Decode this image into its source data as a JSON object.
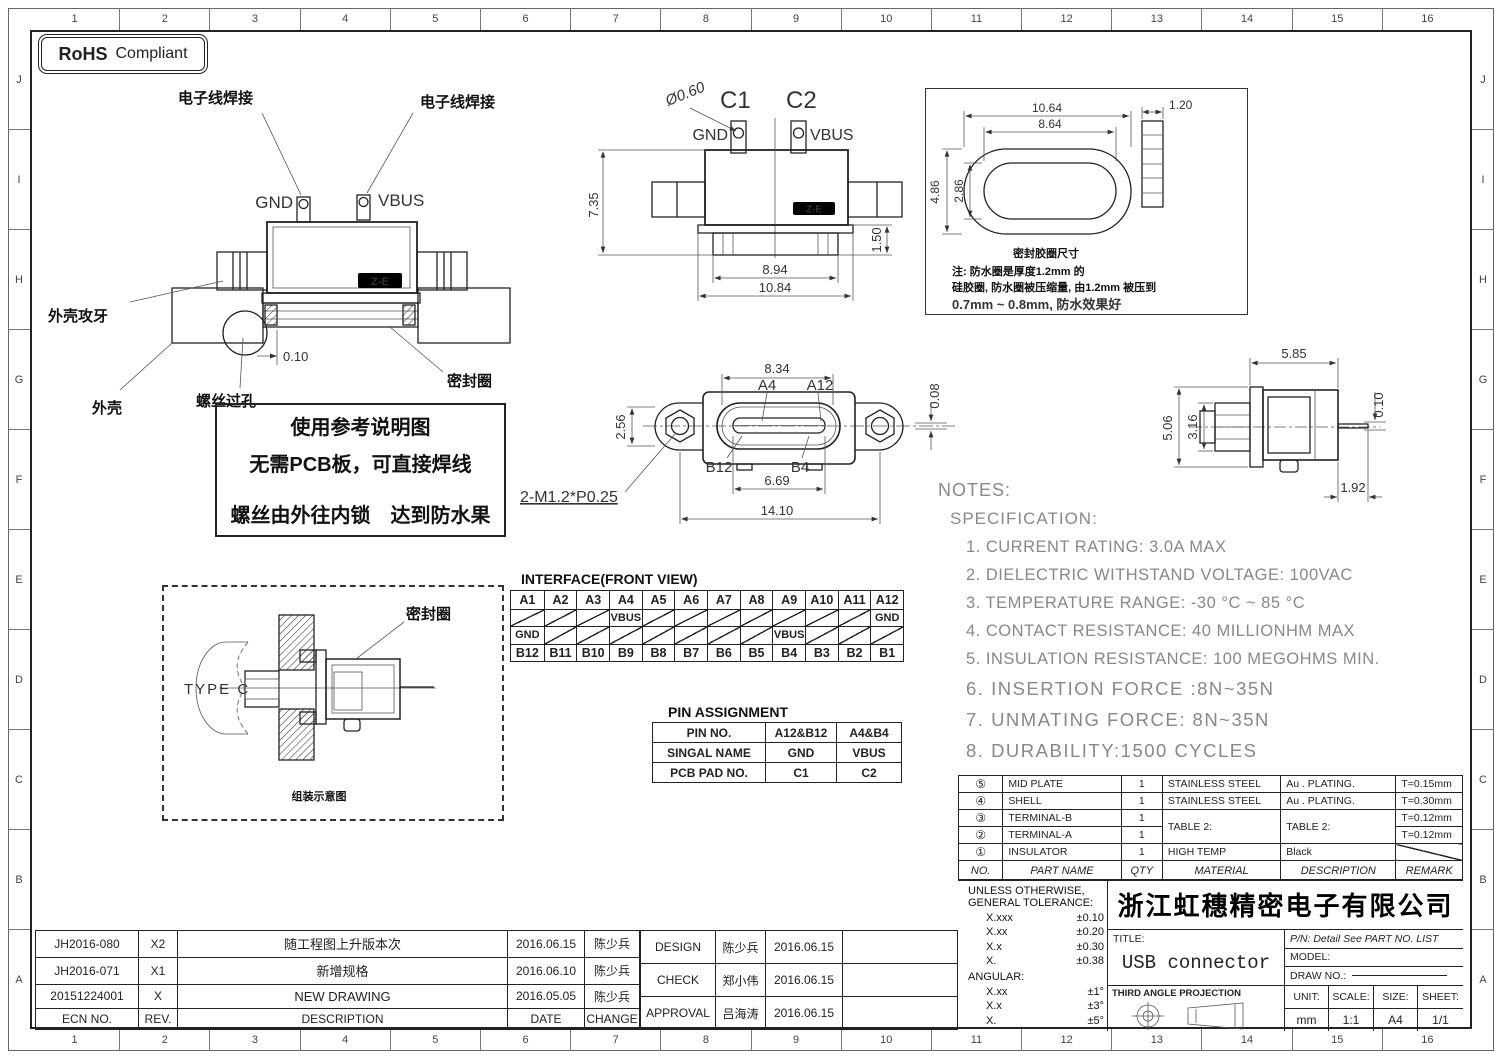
{
  "frame": {
    "cols": [
      "1",
      "2",
      "3",
      "4",
      "5",
      "6",
      "7",
      "8",
      "9",
      "10",
      "11",
      "12",
      "13",
      "14",
      "15",
      "16"
    ],
    "rows": [
      "J",
      "I",
      "H",
      "G",
      "F",
      "E",
      "D",
      "C",
      "B",
      "A"
    ]
  },
  "rohs": {
    "bold": "RoHS",
    "rest": "Compliant"
  },
  "side_view": {
    "wire_weld_left": "电子线焊接",
    "wire_weld_right": "电子线焊接",
    "gnd": "GND",
    "vbus": "VBUS",
    "shell_tap": "外壳攻牙",
    "shell": "外壳",
    "screw_hole": "螺丝过孔",
    "seal_ring": "密封圈",
    "dim_010": "0.10",
    "logo": "Z-E"
  },
  "usage_note": {
    "line1": "使用参考说明图",
    "line2": "无需PCB板，可直接焊线",
    "line3": "螺丝由外往内锁　达到防水果"
  },
  "top_view": {
    "dia": "Ø0.60",
    "c1": "C1",
    "c2": "C2",
    "gnd": "GND",
    "vbus": "VBUS",
    "dim_735": "7.35",
    "dim_894": "8.94",
    "dim_1084": "10.84",
    "dim_150": "1.50",
    "logo": "Z-E"
  },
  "seal_box": {
    "dim_1064": "10.64",
    "dim_864": "8.64",
    "dim_486": "4.86",
    "dim_286": "2.86",
    "dim_120": "1.20",
    "caption": "密封胶圈尺寸",
    "note1": "注: 防水圈是厚度1.2mm 的",
    "note2": "硅胶圈, 防水圈被压缩量, 由1.2mm 被压到",
    "note3": "0.7mm  ~  0.8mm, 防水效果好"
  },
  "front_view": {
    "dim_834": "8.34",
    "a4": "A4",
    "a12": "A12",
    "dim_256": "2.56",
    "dim_008": "0.08",
    "b12": "B12",
    "b4": "B4",
    "dim_669": "6.69",
    "dim_1410": "14.10",
    "thread": "2-M1.2*P0.25"
  },
  "right_view": {
    "dim_585": "5.85",
    "dim_506": "5.06",
    "dim_316": "3.16",
    "dim_010": "0.10",
    "dim_192": "1.92"
  },
  "notes": {
    "title": "NOTES:",
    "subtitle": "SPECIFICATION:",
    "items": [
      "1. CURRENT RATING: 3.0A MAX",
      "2. DIELECTRIC WITHSTAND VOLTAGE: 100VAC",
      "3. TEMPERATURE RANGE: -30 °C ~ 85 °C",
      "4. CONTACT RESISTANCE: 40 MILLIONHM MAX",
      "5. INSULATION RESISTANCE: 100 MEGOHMS MIN.",
      "6.  INSERTION  FORCE  :8N~35N",
      "7.  UNMATING  FORCE:  8N~35N",
      "8.  DURABILITY:1500  CYCLES"
    ]
  },
  "interface_table": {
    "title": "INTERFACE(FRONT VIEW)",
    "row_a": [
      "A1",
      "A2",
      "A3",
      "A4",
      "A5",
      "A6",
      "A7",
      "A8",
      "A9",
      "A10",
      "A11",
      "A12"
    ],
    "row_mid1": {
      "vbus": "VBUS",
      "gnd": "GND"
    },
    "row_mid2": {
      "gnd": "GND",
      "vbus": "VBUS"
    },
    "row_b": [
      "B12",
      "B11",
      "B10",
      "B9",
      "B8",
      "B7",
      "B6",
      "B5",
      "B4",
      "B3",
      "B2",
      "B1"
    ]
  },
  "type_c_box": {
    "label": "TYPE C",
    "seal": "密封圈",
    "caption": "组装示意图"
  },
  "pin_assignment": {
    "title": "PIN ASSIGNMENT",
    "rows": [
      [
        "PIN NO.",
        "A12&B12",
        "A4&B4"
      ],
      [
        "SINGAL NAME",
        "GND",
        "VBUS"
      ],
      [
        "PCB PAD NO.",
        "C1",
        "C2"
      ]
    ]
  },
  "parts_table": {
    "header": [
      "NO.",
      "PART NAME",
      "QTY",
      "MATERIAL",
      "DESCRIPTION",
      "REMARK"
    ],
    "rows": [
      {
        "no": "⑤",
        "name": "MID PLATE",
        "qty": "1",
        "material": "STAINLESS STEEL",
        "desc": "Au . PLATING.",
        "remark": "T=0.15mm"
      },
      {
        "no": "④",
        "name": "SHELL",
        "qty": "1",
        "material": "STAINLESS STEEL",
        "desc": "Au . PLATING.",
        "remark": "T=0.30mm"
      },
      {
        "no": "③",
        "name": "TERMINAL-B",
        "qty": "1",
        "material": "TABLE 2:",
        "desc": "TABLE 2:",
        "remark": "T=0.12mm"
      },
      {
        "no": "②",
        "name": "TERMINAL-A",
        "qty": "1",
        "remark": "T=0.12mm"
      },
      {
        "no": "①",
        "name": "INSULATOR",
        "qty": "1",
        "material": "HIGH TEMP",
        "desc": "Black",
        "remark": ""
      }
    ]
  },
  "title_block": {
    "tol_line1": "UNLESS OTHERWISE,",
    "tol_line2": "GENERAL TOLERANCE:",
    "tolerances": [
      [
        "X.xxx",
        "±0.10"
      ],
      [
        "X.xx",
        "±0.20"
      ],
      [
        "X.x",
        "±0.30"
      ],
      [
        "X.",
        "±0.38"
      ]
    ],
    "angular_title": "ANGULAR:",
    "angular": [
      [
        "X.xx",
        "±1°"
      ],
      [
        "X.x",
        "±3°"
      ],
      [
        "X.",
        "±5°"
      ]
    ],
    "company": "浙江虹穗精密电子有限公司",
    "title_label": "TITLE:",
    "title_value": "USB connector",
    "pn": "P/N: Detail See PART NO. LIST",
    "model_label": "MODEL:",
    "draw_no_label": "DRAW NO.:",
    "projection": "THIRD ANGLE PROJECTION",
    "unit_label": "UNIT:",
    "unit_value": "mm",
    "scale_label": "SCALE:",
    "scale_value": "1:1",
    "size_label": "SIZE:",
    "size_value": "A4",
    "sheet_label": "SHEET:",
    "sheet_value": "1/1"
  },
  "revision_table": {
    "rows": [
      [
        "JH2016-080",
        "X2",
        "随工程图上升版本次",
        "2016.06.15",
        "陈少兵"
      ],
      [
        "JH2016-071",
        "X1",
        "新增规格",
        "2016.06.10",
        "陈少兵"
      ],
      [
        "20151224001",
        "X",
        "NEW DRAWING",
        "2016.05.05",
        "陈少兵"
      ]
    ],
    "header": [
      "ECN NO.",
      "REV.",
      "DESCRIPTION",
      "DATE",
      "CHANGE"
    ]
  },
  "approval_block": {
    "rows": [
      [
        "DESIGN",
        "陈少兵",
        "2016.06.15"
      ],
      [
        "CHECK",
        "郑小伟",
        "2016.06.15"
      ],
      [
        "APPROVAL",
        "吕海涛",
        "2016.06.15"
      ]
    ]
  }
}
